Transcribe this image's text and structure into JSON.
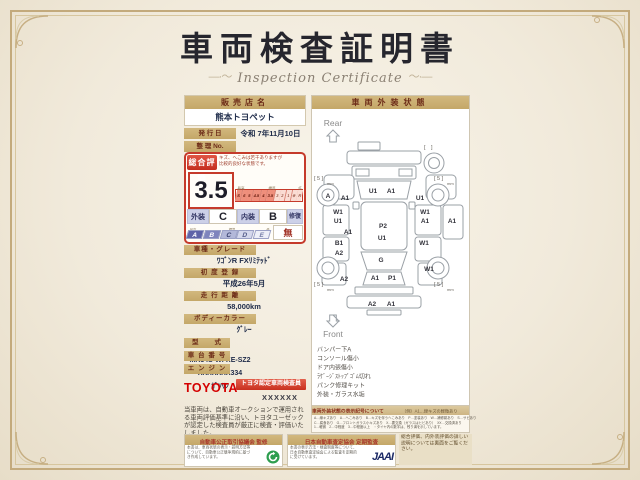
{
  "title": "車両検査証明書",
  "subtitle": "Inspection Certificate",
  "left": {
    "dealer_label": "販売店名",
    "dealer_name": "熊本トヨペット",
    "issue_label": "発 行 日",
    "issue_value": "令和 7年11月10日",
    "ref_label": "整 理 No.",
    "ref_value": "",
    "eval": {
      "header": "総合評価",
      "comment1": "キズ、へこみは若干ありますが",
      "comment2": "比較的良好な状態です。",
      "score": "3.5",
      "lbl_high": "最高",
      "lbl_std": "標準",
      "lbl_low": "低",
      "scale": [
        "S",
        "6",
        "5",
        "4.5",
        "4",
        "3.5",
        "3",
        "2",
        "1",
        "※",
        "R"
      ],
      "ext_label": "外装",
      "ext_value": "C",
      "int_label": "内装",
      "int_value": "B",
      "repair_label": "修復歴",
      "repair_value": "無",
      "grades": [
        "A",
        "B",
        "C",
        "D",
        "E"
      ]
    },
    "fields": [
      {
        "label": "車種・グレード",
        "value": "ﾜｺﾞﾝR FXﾘﾐﾃｯﾄﾞ"
      },
      {
        "label": "初 度 登 録",
        "value": "平成26年5月"
      },
      {
        "label": "走 行 距 離",
        "value": "58,000km"
      },
      {
        "label": "ボディーカラー",
        "value": "ｸﾞﾚｰ"
      },
      {
        "label": "型　　式",
        "value": "MH34S-WFXE-SZ2"
      },
      {
        "label": "車 台 番 号",
        "value": "XXXXXXX334"
      },
      {
        "label": "エ ン ジ ン",
        "value": "ｶﾞｿﾘﾝ"
      }
    ],
    "toyota": "TOYOTA",
    "badge": "トヨタ認定車両検査員",
    "inspector_no": "XXXXXX",
    "disclaimer": "当車両は、自動車オークションで運用される車両評価基準に沿い、トヨタユーゼックが認定した検査員が厳正に検査・評価いたしました。"
  },
  "right": {
    "header": "車両外装状態",
    "rear": "Rear",
    "front": "Front",
    "notes": [
      "バンパー下A",
      "コンソール傷小",
      "ドア内張傷小",
      "ﾗｹﾞｰｼﾞｽﾄｯﾌﾟｺﾞﾑ切れ",
      "パンク修理キット",
      "外装・ガラス水垢"
    ],
    "legend_title": "車両外装状態の表示記号について",
    "legend_example": "（例）A1…線キズの軽微あり",
    "legend1": "A…線キズあり　U…へこみあり　B…キズを伴うへこみあり　P…塗装あり　W…補修跡あり　S…サビあり",
    "legend2": "C…腐食あり　G…フロントガラス小キズあり　X…要交換（ガラスはヒビあり）　XX…交換済あり",
    "legend3": "1…軽微　2…中程度　3…中程度以上　・タイヤ内の数字は、残り溝を示しています。"
  },
  "diagram": {
    "markers": [
      "U1",
      "A1",
      "A",
      "A1",
      "U1",
      "W1",
      "U1",
      "A1",
      "W1",
      "A1",
      "A1",
      "P2",
      "U1",
      "B1",
      "A2",
      "W1",
      "G",
      "A2",
      "W1",
      "A1",
      "P1",
      "A2",
      "A1"
    ],
    "tread_rl": "[ 5 ]",
    "tread_rr": "[ 5 ]",
    "tread_fl": "[ 5 ]",
    "tread_fr": "[ 5 ]",
    "tread_spare": "[　]",
    "unit": "mm"
  },
  "footer": {
    "fair_title": "自動車公正取引協議会 監修",
    "fair_body": "本書は、車両状態の表示・説明方法等について、自動車公正競争規約に基づき作成しています。",
    "audit_title": "日本自動車査定協会 定期監査",
    "audit_body": "本書の表示方法・検査制度等について、日本自動車査定協会による監査を定期的に受けています。",
    "jaai": "JAAI",
    "back_note": "総合評価、内外装評価の詳しい説明については裏面をご覧ください。"
  }
}
